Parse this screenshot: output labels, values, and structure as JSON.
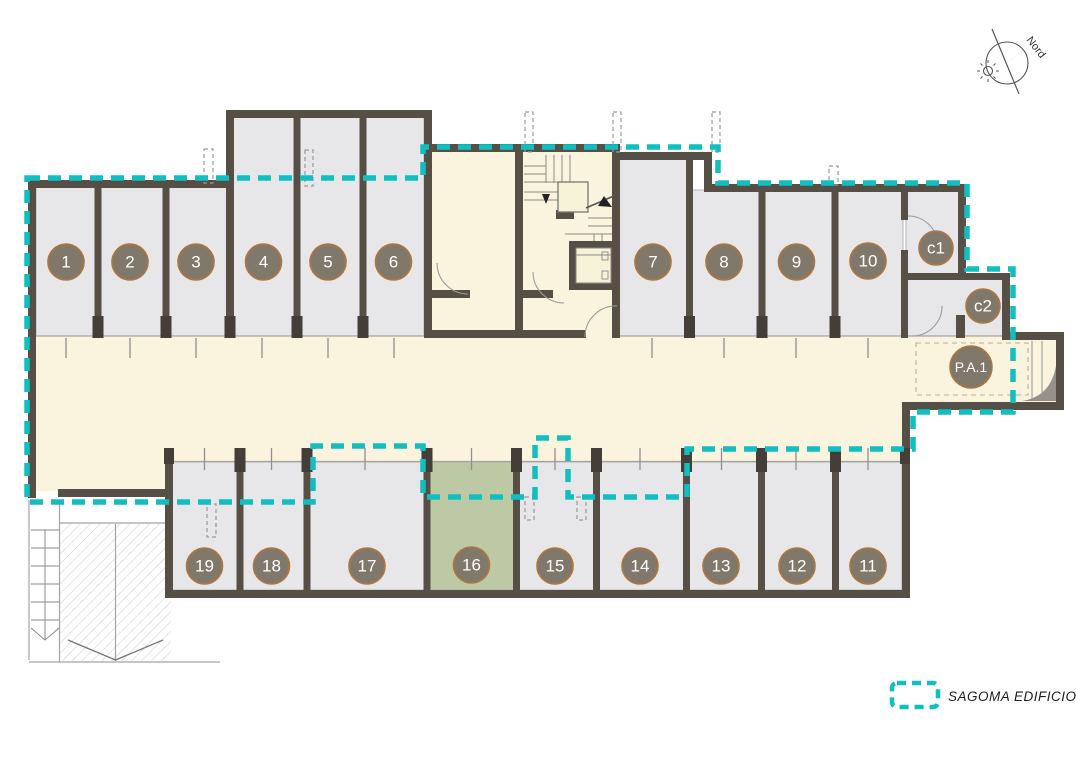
{
  "plan": {
    "north_label": "Nord",
    "legend": {
      "swatch": "dashed-teal-rectangle",
      "label": "SAGOMA EDIFICIO"
    }
  },
  "rooms": [
    {
      "id": "1",
      "label": "1",
      "zone": "top",
      "highlighted": false
    },
    {
      "id": "2",
      "label": "2",
      "zone": "top",
      "highlighted": false
    },
    {
      "id": "3",
      "label": "3",
      "zone": "top",
      "highlighted": false
    },
    {
      "id": "4",
      "label": "4",
      "zone": "top",
      "highlighted": false
    },
    {
      "id": "5",
      "label": "5",
      "zone": "top",
      "highlighted": false
    },
    {
      "id": "6",
      "label": "6",
      "zone": "top",
      "highlighted": false
    },
    {
      "id": "7",
      "label": "7",
      "zone": "top",
      "highlighted": false
    },
    {
      "id": "8",
      "label": "8",
      "zone": "top",
      "highlighted": false
    },
    {
      "id": "9",
      "label": "9",
      "zone": "top",
      "highlighted": false
    },
    {
      "id": "10",
      "label": "10",
      "zone": "top",
      "highlighted": false
    },
    {
      "id": "11",
      "label": "11",
      "zone": "bottom",
      "highlighted": false
    },
    {
      "id": "12",
      "label": "12",
      "zone": "bottom",
      "highlighted": false
    },
    {
      "id": "13",
      "label": "13",
      "zone": "bottom",
      "highlighted": false
    },
    {
      "id": "14",
      "label": "14",
      "zone": "bottom",
      "highlighted": false
    },
    {
      "id": "15",
      "label": "15",
      "zone": "bottom",
      "highlighted": false
    },
    {
      "id": "16",
      "label": "16",
      "zone": "bottom",
      "highlighted": true
    },
    {
      "id": "17",
      "label": "17",
      "zone": "bottom",
      "highlighted": false
    },
    {
      "id": "18",
      "label": "18",
      "zone": "bottom",
      "highlighted": false
    },
    {
      "id": "19",
      "label": "19",
      "zone": "bottom",
      "highlighted": false
    },
    {
      "id": "c1",
      "label": "c1",
      "zone": "top-right",
      "highlighted": false
    },
    {
      "id": "c2",
      "label": "c2",
      "zone": "top-right",
      "highlighted": false
    },
    {
      "id": "P.A.1",
      "label": "P.A.1",
      "zone": "corridor-right",
      "highlighted": false
    }
  ],
  "colors": {
    "accent_outline": "#12bfc0",
    "wall": "#564f46",
    "room_fill": "#e7e7e9",
    "corridor_fill": "#faf4de",
    "highlight_room_fill": "#bcc9a4",
    "badge_fill": "#81786c",
    "badge_border": "#b0763c",
    "badge_text": "#ffffff"
  }
}
